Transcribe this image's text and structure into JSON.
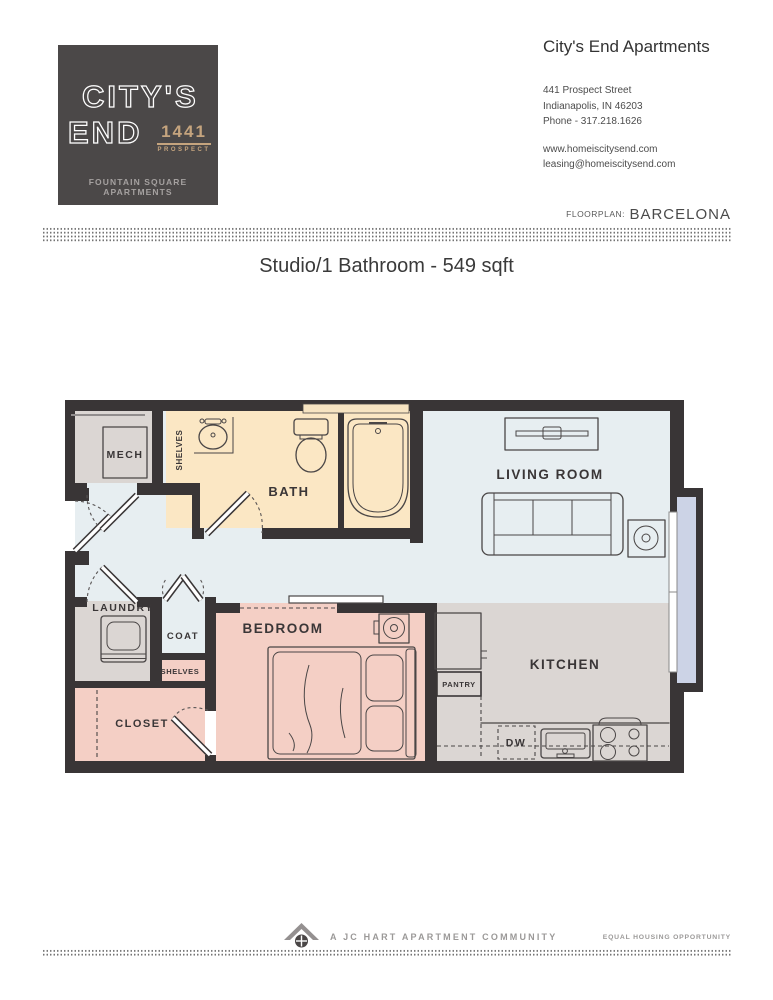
{
  "logo": {
    "line1": "CITY'S",
    "line2": "END",
    "badge_number": "1441",
    "badge_text": "PROSPECT",
    "tagline": "FOUNTAIN SQUARE APARTMENTS"
  },
  "header": {
    "title": "City's End Apartments",
    "address_line1": "441 Prospect Street",
    "address_line2": "Indianapolis, IN 46203",
    "phone": "Phone - 317.218.1626",
    "website": "www.homeiscitysend.com",
    "email": "leasing@homeiscitysend.com"
  },
  "floorplan_bar": {
    "label": "FLOORPLAN:",
    "name": "BARCELONA"
  },
  "subtitle": "Studio/1 Bathroom - 549 sqft",
  "plan": {
    "labels": {
      "mech": "MECH",
      "shelves_bath": "SHELVES",
      "bath": "BATH",
      "living_room": "LIVING ROOM",
      "laundry": "LAUNDRY",
      "coat": "COAT",
      "shelves_closet": "SHELVES",
      "closet": "CLOSET",
      "bedroom": "BEDROOM",
      "pantry": "PANTRY",
      "kitchen": "KITCHEN",
      "dishwasher": "DW"
    }
  },
  "footer": {
    "community": "A JC HART APARTMENT COMMUNITY",
    "equal_housing": "EQUAL HOUSING OPPORTUNITY"
  },
  "colors": {
    "wall": "#393536",
    "floor_main": "#e7eef1",
    "floor_kitchen": "#dbd6d3",
    "floor_bedroom": "#f4cfc5",
    "floor_bath": "#fbe7c4",
    "window_glass": "#ccd3e6",
    "logo_bg": "#4b4848",
    "logo_accent": "#c5a47e"
  }
}
